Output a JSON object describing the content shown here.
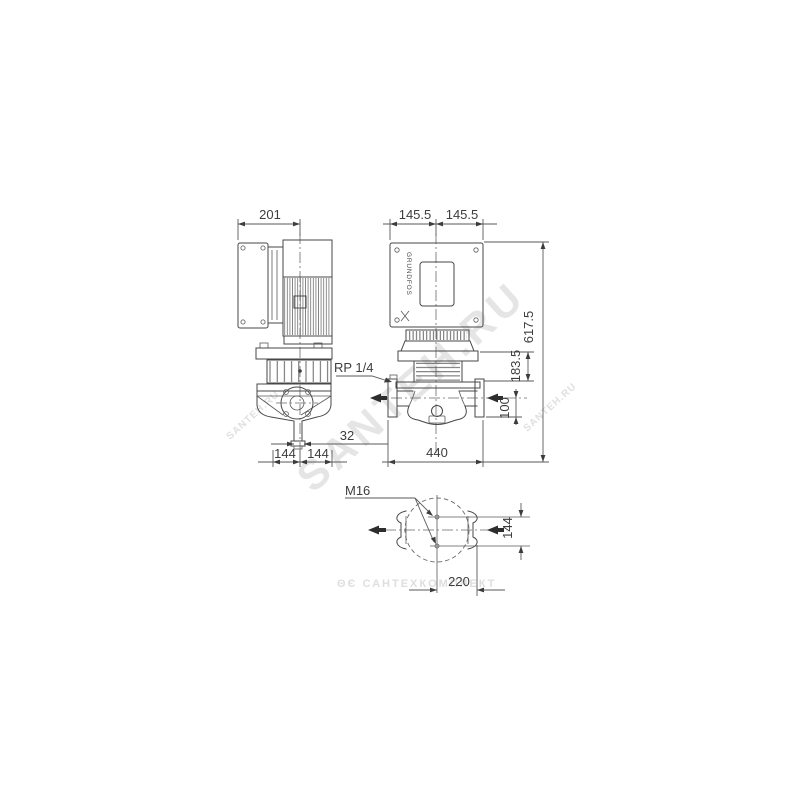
{
  "drawing": {
    "type": "technical-dimension-drawing",
    "subject": "in-line pump with motor: side view, front view and plan (foot) view",
    "brand": "GRUNDFOS"
  },
  "dims": {
    "d201": "201",
    "d145a": "145.5",
    "d145b": "145.5",
    "d617": "617.5",
    "d183": "183.5",
    "d100": "100",
    "d440": "440",
    "d32": "32",
    "d144a": "144",
    "d144b": "144",
    "d144c": "144",
    "d220": "220"
  },
  "labels": {
    "rp": "RP 1/4",
    "m16": "M16",
    "brand": "GRUNDFOS"
  },
  "watermarks": {
    "diag": "SANTEH.RU",
    "bottom": "ΘЄ САНТЕХКОМПЛЕКТ"
  }
}
